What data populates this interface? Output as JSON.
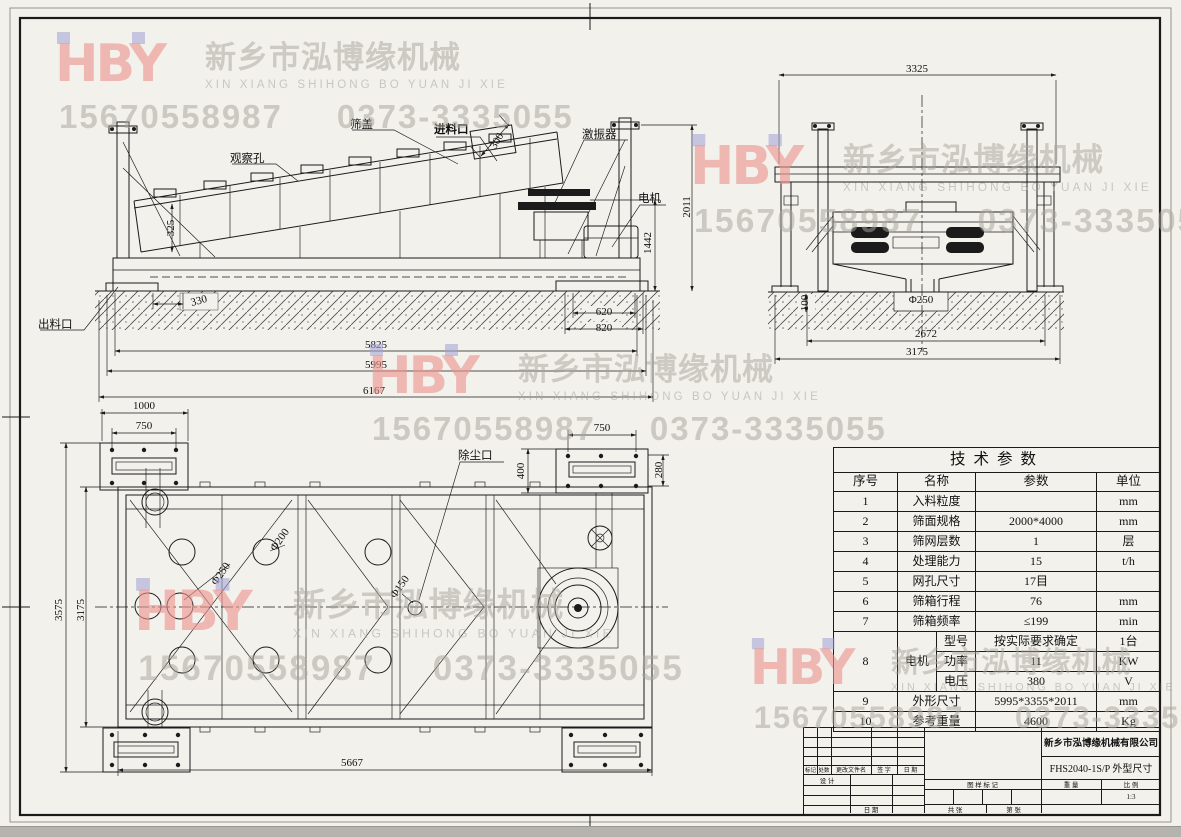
{
  "watermark": {
    "logo": "HBY",
    "company_cn": "新乡市泓博缘机械",
    "company_py": "XIN XIANG SHIHONG BO YUAN JI XIE",
    "phone1": "15670558987",
    "phone2": "0373-3335055",
    "logo_color": "#ee938d",
    "accent_square_color": "#a3a0d6",
    "text_color": "#a6a49a"
  },
  "side_view": {
    "labels": {
      "cover": "筛盖",
      "inspection_hole": "观察孔",
      "feed_inlet": "进料口",
      "exciter": "激振器",
      "motor": "电机",
      "discharge_outlet": "出料口"
    },
    "dims": {
      "inlet_width": "300",
      "left_end_height": "325",
      "base_offset": "330",
      "foot_inner": "620",
      "foot_outer": "820",
      "base_length": "5825",
      "frame_length": "5995",
      "total_length": "6167",
      "frame_height": "1442",
      "total_height": "2011"
    }
  },
  "end_view": {
    "dims": {
      "total_width": "3325",
      "pit_depth": "100",
      "discharge_dia": "Φ250",
      "support_span": "2672",
      "base_width": "3175"
    }
  },
  "plan_view": {
    "labels": {
      "dust_port": "除尘口"
    },
    "dims": {
      "plate_len": "1000",
      "plate_bolt_left": "750",
      "plate_bolt_right": "750",
      "plate_width": "400",
      "plate_offset": "280",
      "total_width": "3575",
      "frame_width": "3175",
      "bolt_span": "5667",
      "hole_250": "Φ250",
      "hole_200": "Φ200",
      "hole_150": "Φ150"
    }
  },
  "param_table": {
    "title": "技术参数",
    "headers": [
      "序号",
      "名称",
      "参数",
      "单位"
    ],
    "rows": [
      {
        "no": "1",
        "name": "入料粒度",
        "value": "",
        "unit": "mm"
      },
      {
        "no": "2",
        "name": "筛面规格",
        "value": "2000*4000",
        "unit": "mm"
      },
      {
        "no": "3",
        "name": "筛网层数",
        "value": "1",
        "unit": "层"
      },
      {
        "no": "4",
        "name": "处理能力",
        "value": "15",
        "unit": "t/h"
      },
      {
        "no": "5",
        "name": "网孔尺寸",
        "value": "17目",
        "unit": ""
      },
      {
        "no": "6",
        "name": "筛箱行程",
        "value": "76",
        "unit": "mm"
      },
      {
        "no": "7",
        "name": "筛箱频率",
        "value": "≤199",
        "unit": "min"
      }
    ],
    "motor_row": {
      "no": "8",
      "name": "电机",
      "subrows": [
        {
          "label": "型号",
          "value": "按实际要求确定",
          "unit": "1台"
        },
        {
          "label": "功率",
          "value": "11",
          "unit": "KW"
        },
        {
          "label": "电压",
          "value": "380",
          "unit": "V"
        }
      ]
    },
    "rows_tail": [
      {
        "no": "9",
        "name": "外形尺寸",
        "value": "5995*3355*2011",
        "unit": "mm"
      },
      {
        "no": "10",
        "name": "参考重量",
        "value": "4600",
        "unit": "Kg"
      }
    ]
  },
  "title_block": {
    "company": "新乡市泓博缘机械有限公司",
    "drawing_title": "FHS2040-1S/P  外型尺寸",
    "scale_value": "1:3",
    "labels": {
      "mark": "标记",
      "count": "处数",
      "change_file": "更改文件名",
      "signature": "签 字",
      "date": "日 期",
      "design": "设 计",
      "date2": "日 期",
      "drawing_mark": "图 样 标 记",
      "weight": "重 量",
      "scale": "比 例",
      "sheets_total": "共  张",
      "sheet_no": "第  张"
    }
  }
}
